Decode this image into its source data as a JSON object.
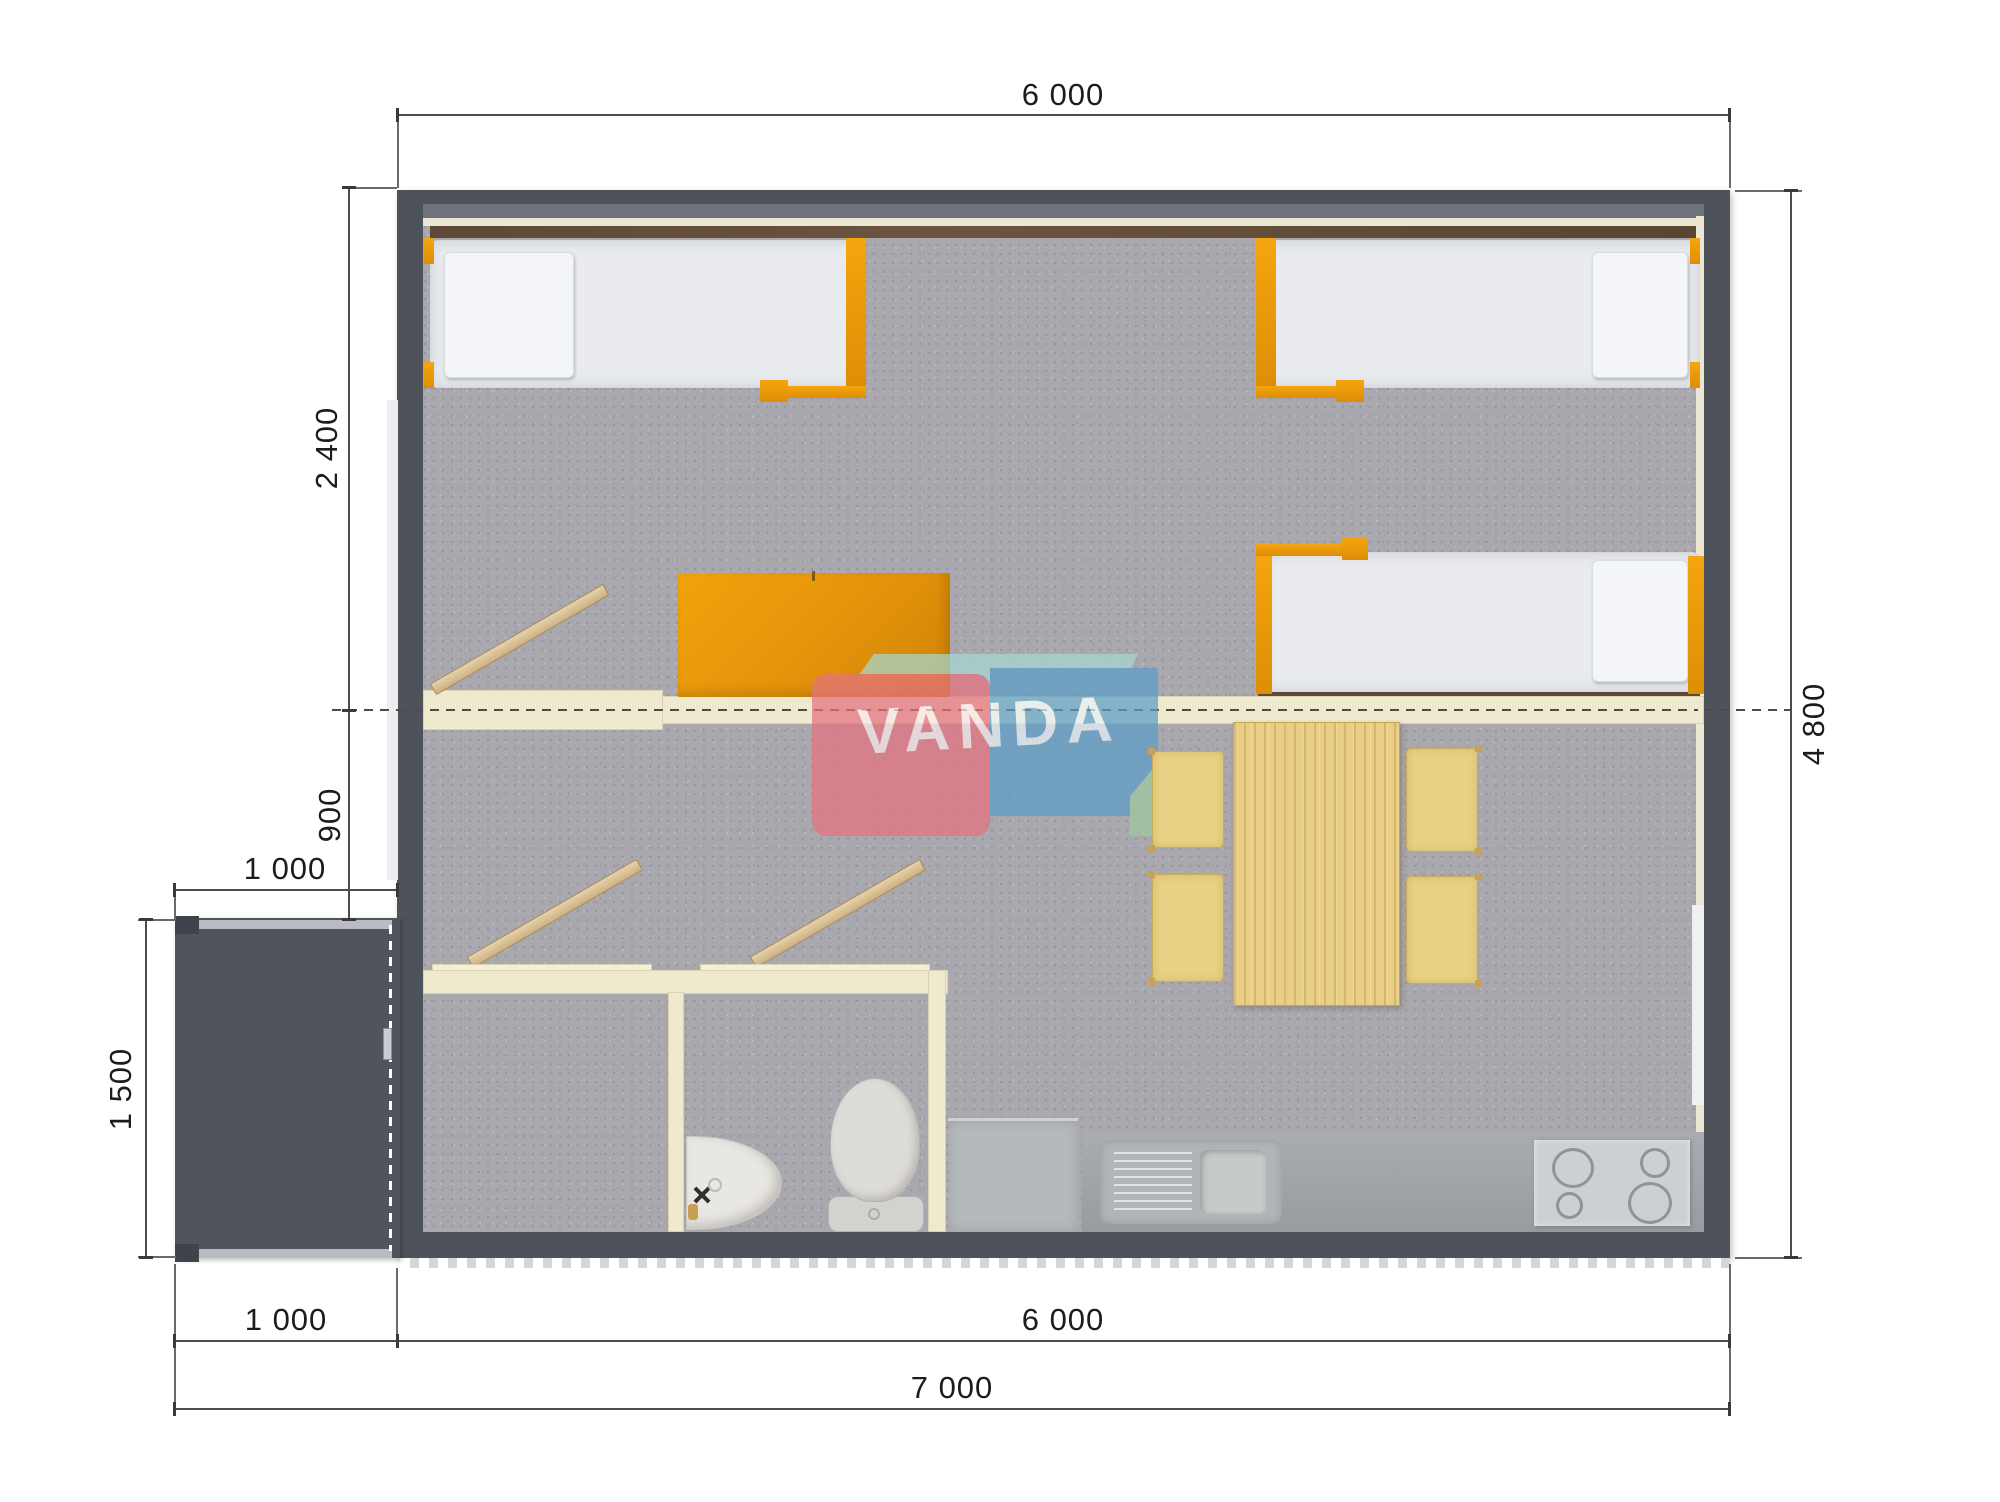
{
  "drawing": {
    "type": "floor-plan",
    "watermark": {
      "brand": "VANDA"
    },
    "dimensions": {
      "top_width": "6 000",
      "right_height": "4 800",
      "left_bedroom_depth": "2 400",
      "left_living_depth": "900",
      "porch_width_upper": "1 000",
      "porch_height": "1 500",
      "bottom_porch_width": "1 000",
      "bottom_main_width": "6 000",
      "bottom_total_width": "7 000"
    },
    "rooms": {
      "furniture": [
        "single-bed-top-left",
        "single-bed-top-right",
        "single-bed-middle-right",
        "orange-desk",
        "dining-table",
        "chair-1",
        "chair-2",
        "chair-3",
        "chair-4",
        "wardrobe-planks",
        "bathroom-stalls",
        "washbasin",
        "toilet",
        "shower-unit",
        "kitchen-counter",
        "kitchen-sink",
        "stove",
        "entrance-porch"
      ]
    },
    "colors": {
      "wall": "#4e535b",
      "floor_carpet": "#a9a8ae",
      "partition_cream": "#efe9cd",
      "accent_orange": "#ef9c09",
      "mattress_white": "#e9ebef",
      "wood_table": "#e9cf86",
      "counter_gray": "#a0a5aa",
      "logo_pink": "#e57380",
      "logo_blue": "#5c9dc8",
      "logo_teal": "#a5d8d2",
      "logo_green": "#9dc8a2"
    }
  }
}
